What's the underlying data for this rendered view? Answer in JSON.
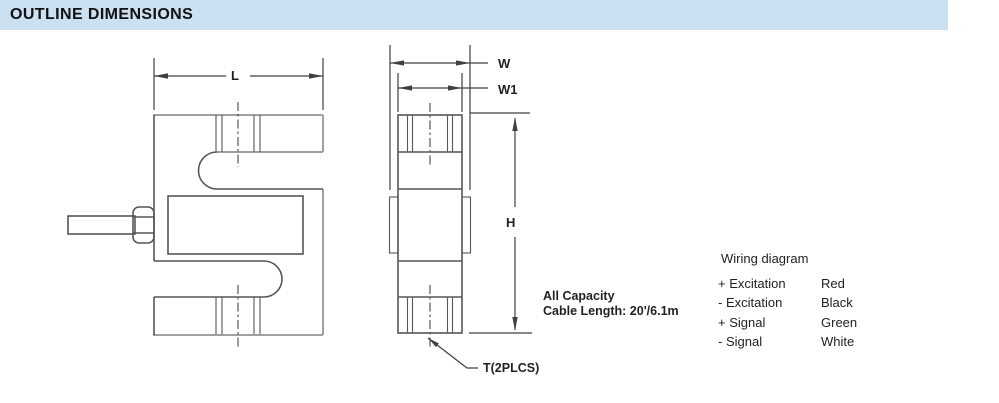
{
  "header": {
    "title": "OUTLINE DIMENSIONS"
  },
  "front_view": {
    "dim_length": "L"
  },
  "side_view": {
    "dim_width": "W",
    "dim_width_inner": "W1",
    "dim_height": "H",
    "thread_callout": "T(2PLCS)"
  },
  "note": {
    "line1": "All Capacity",
    "line2": "Cable Length: 20'/6.1m"
  },
  "wiring": {
    "title": "Wiring diagram",
    "rows": [
      {
        "signal": "+ Excitation",
        "color": "Red"
      },
      {
        "signal": "- Excitation",
        "color": "Black"
      },
      {
        "signal": "+ Signal",
        "color": "Green"
      },
      {
        "signal": "- Signal",
        "color": "White"
      }
    ]
  },
  "colors": {
    "header_bg": "#cbe0f0",
    "line_dark": "#56575a",
    "line_gray": "#9ea1a4",
    "line_dim": "#3f4043",
    "text_dark": "#242125"
  }
}
